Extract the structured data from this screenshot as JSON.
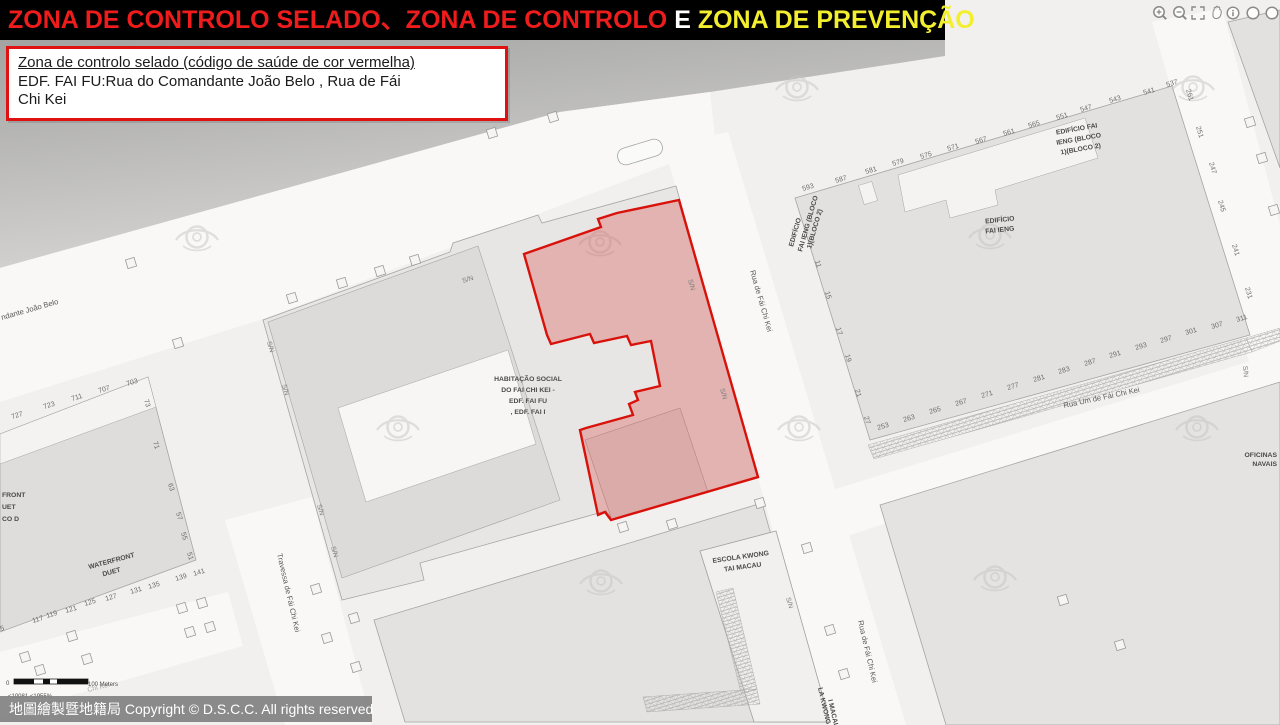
{
  "header": {
    "segments": {
      "red": "ZONA DE CONTROLO SELADO、ZONA DE CONTROLO ",
      "white": "E ",
      "yellow": "ZONA DE PREVENÇÃO"
    },
    "colors": {
      "red": "#ee1c1c",
      "white": "#ffffff",
      "yellow": "#f3ef2f",
      "bg": "#000000"
    }
  },
  "toolbar": {
    "icons": [
      "zoom-in",
      "zoom-out",
      "full-extent",
      "pan",
      "identify",
      "prev-extent",
      "next-extent"
    ]
  },
  "info_box": {
    "line1": "Zona de controlo selado (código de saúde de cor vermelha)",
    "line2": "EDF. FAI FU:Rua do Comandante João Belo , Rua de Fái",
    "line3": "Chi Kei",
    "border_color": "#e01111"
  },
  "zone": {
    "name": "Zona de controlo selado",
    "stroke": "#d8120b",
    "fill": "rgba(214,48,42,0.28)"
  },
  "scale_bar": {
    "zero": "0",
    "label": "100 Meters",
    "sub": "<10081  <1955%"
  },
  "copyright": {
    "text": "地圖繪製暨地籍局 Copyright © D.S.C.C. All rights reserved"
  },
  "map": {
    "labels": [
      {
        "t": "ndante João Belo",
        "x": 2,
        "y": 320,
        "r": -16,
        "c": "street"
      },
      {
        "t": "Rua de Fái Chi Kei",
        "x": 750,
        "y": 271,
        "r": 74,
        "c": "street"
      },
      {
        "t": "Rua Um de Fái Chi Kei",
        "x": 1064,
        "y": 408,
        "r": -12,
        "c": "street"
      },
      {
        "t": "Travessa de Fái Chi Kei",
        "x": 277,
        "y": 554,
        "r": 77,
        "c": "street"
      },
      {
        "t": "Rua de Fái Chi Kei",
        "x": 858,
        "y": 621,
        "r": 77,
        "c": "street"
      },
      {
        "t": "Chi Kei",
        "x": 88,
        "y": 692,
        "r": -14,
        "c": "faint"
      },
      {
        "t": "S/N",
        "x": 463,
        "y": 283,
        "r": -17,
        "c": "sn"
      },
      {
        "t": "S/N",
        "x": 688,
        "y": 280,
        "r": 74,
        "c": "sn"
      },
      {
        "t": "S/N",
        "x": 720,
        "y": 389,
        "r": 74,
        "c": "sn"
      },
      {
        "t": "S/N",
        "x": 267,
        "y": 342,
        "r": 74,
        "c": "sn"
      },
      {
        "t": "S/N",
        "x": 282,
        "y": 385,
        "r": 74,
        "c": "sn"
      },
      {
        "t": "S/N",
        "x": 317,
        "y": 505,
        "r": 74,
        "c": "sn"
      },
      {
        "t": "S/N",
        "x": 331,
        "y": 547,
        "r": 74,
        "c": "sn"
      },
      {
        "t": "S/N",
        "x": 786,
        "y": 598,
        "r": 74,
        "c": "sn"
      },
      {
        "t": "S/N",
        "x": 1243,
        "y": 366,
        "r": 85,
        "c": "sn"
      },
      {
        "t": "HABITAÇÃO SOCIAL",
        "x": 528,
        "y": 381,
        "c": "bldg",
        "a": "middle"
      },
      {
        "t": "DO FAI CHI KEI -",
        "x": 528,
        "y": 392,
        "c": "bldg",
        "a": "middle"
      },
      {
        "t": "EDF. FAI FU",
        "x": 528,
        "y": 403,
        "c": "bldg",
        "a": "middle"
      },
      {
        "t": ", EDF. FAI I",
        "x": 528,
        "y": 414,
        "c": "bldg",
        "a": "middle"
      },
      {
        "t": "EDIFÍCIO",
        "x": 1000,
        "y": 222,
        "r": -6,
        "c": "bldg",
        "a": "middle"
      },
      {
        "t": "FAI IENG",
        "x": 1000,
        "y": 232,
        "r": -6,
        "c": "bldg",
        "a": "middle"
      },
      {
        "t": "EDIFÍCIO FAI",
        "x": 1077,
        "y": 131,
        "r": -10,
        "c": "bldg",
        "a": "middle"
      },
      {
        "t": "IENG (BLOCO",
        "x": 1079,
        "y": 141,
        "r": -10,
        "c": "bldg",
        "a": "middle"
      },
      {
        "t": "1)(BLOCO 2)",
        "x": 1081,
        "y": 151,
        "r": -10,
        "c": "bldg",
        "a": "middle"
      },
      {
        "t": "EDIFÍCIO",
        "x": 793,
        "y": 247,
        "r": -74,
        "c": "bldg"
      },
      {
        "t": "FAI IENG (BLOCO",
        "x": 802,
        "y": 252,
        "r": -74,
        "c": "bldg"
      },
      {
        "t": "1)(BLOCO 2)",
        "x": 811,
        "y": 249,
        "r": -74,
        "c": "bldg"
      },
      {
        "t": "ESCOLA KWONG",
        "x": 741,
        "y": 559,
        "r": -8,
        "c": "bldg",
        "a": "middle"
      },
      {
        "t": "TAI MACAU",
        "x": 743,
        "y": 569,
        "r": -8,
        "c": "bldg",
        "a": "middle"
      },
      {
        "t": "WATERFRONT",
        "x": 112,
        "y": 563,
        "r": -15,
        "c": "bldg",
        "a": "middle"
      },
      {
        "t": "DUET",
        "x": 112,
        "y": 574,
        "r": -15,
        "c": "bldg",
        "a": "middle"
      },
      {
        "t": "OFICINAS",
        "x": 1277,
        "y": 457,
        "c": "bldg",
        "a": "end"
      },
      {
        "t": "NAVAIS",
        "x": 1277,
        "y": 466,
        "c": "bldg",
        "a": "end"
      },
      {
        "t": "FRONT",
        "x": 2,
        "y": 497,
        "c": "bldg"
      },
      {
        "t": "UET",
        "x": 2,
        "y": 509,
        "c": "bldg"
      },
      {
        "t": "CO D",
        "x": 2,
        "y": 521,
        "c": "bldg"
      },
      {
        "t": "LA KWONG",
        "x": 818,
        "y": 688,
        "r": 77,
        "c": "bldg"
      },
      {
        "t": "I MACAU",
        "x": 828,
        "y": 700,
        "r": 77,
        "c": "bldg"
      },
      {
        "t": "593",
        "x": 803,
        "y": 191,
        "r": -17
      },
      {
        "t": "587",
        "x": 836,
        "y": 183,
        "r": -17
      },
      {
        "t": "581",
        "x": 866,
        "y": 174,
        "r": -17
      },
      {
        "t": "579",
        "x": 893,
        "y": 166,
        "r": -17
      },
      {
        "t": "575",
        "x": 921,
        "y": 159,
        "r": -17
      },
      {
        "t": "571",
        "x": 948,
        "y": 151,
        "r": -17
      },
      {
        "t": "567",
        "x": 976,
        "y": 144,
        "r": -17
      },
      {
        "t": "561",
        "x": 1004,
        "y": 136,
        "r": -17
      },
      {
        "t": "565",
        "x": 1029,
        "y": 128,
        "r": -17
      },
      {
        "t": "551",
        "x": 1057,
        "y": 120,
        "r": -17
      },
      {
        "t": "547",
        "x": 1081,
        "y": 112,
        "r": -17
      },
      {
        "t": "543",
        "x": 1110,
        "y": 103,
        "r": -17
      },
      {
        "t": "541",
        "x": 1144,
        "y": 95,
        "r": -17
      },
      {
        "t": "537",
        "x": 1167,
        "y": 87,
        "r": -17
      },
      {
        "t": "261",
        "x": 1186,
        "y": 90,
        "r": 73
      },
      {
        "t": "251",
        "x": 1196,
        "y": 127,
        "r": 73
      },
      {
        "t": "247",
        "x": 1209,
        "y": 163,
        "r": 73
      },
      {
        "t": "245",
        "x": 1218,
        "y": 201,
        "r": 73
      },
      {
        "t": "241",
        "x": 1232,
        "y": 245,
        "r": 73
      },
      {
        "t": "231",
        "x": 1245,
        "y": 288,
        "r": 73
      },
      {
        "t": "11",
        "x": 815,
        "y": 261,
        "r": 73
      },
      {
        "t": "15",
        "x": 825,
        "y": 292,
        "r": 73
      },
      {
        "t": "17",
        "x": 836,
        "y": 328,
        "r": 73
      },
      {
        "t": "19",
        "x": 845,
        "y": 355,
        "r": 73
      },
      {
        "t": "21",
        "x": 855,
        "y": 390,
        "r": 73
      },
      {
        "t": "27",
        "x": 864,
        "y": 417,
        "r": 73
      },
      {
        "t": "253",
        "x": 878,
        "y": 430,
        "r": -17
      },
      {
        "t": "263",
        "x": 904,
        "y": 422,
        "r": -17
      },
      {
        "t": "265",
        "x": 930,
        "y": 414,
        "r": -17
      },
      {
        "t": "267",
        "x": 956,
        "y": 406,
        "r": -17
      },
      {
        "t": "271",
        "x": 982,
        "y": 398,
        "r": -17
      },
      {
        "t": "277",
        "x": 1008,
        "y": 390,
        "r": -17
      },
      {
        "t": "281",
        "x": 1034,
        "y": 382,
        "r": -17
      },
      {
        "t": "283",
        "x": 1059,
        "y": 374,
        "r": -17
      },
      {
        "t": "287",
        "x": 1085,
        "y": 366,
        "r": -17
      },
      {
        "t": "291",
        "x": 1110,
        "y": 358,
        "r": -17
      },
      {
        "t": "293",
        "x": 1136,
        "y": 350,
        "r": -17
      },
      {
        "t": "297",
        "x": 1161,
        "y": 343,
        "r": -17
      },
      {
        "t": "301",
        "x": 1186,
        "y": 335,
        "r": -17
      },
      {
        "t": "307",
        "x": 1212,
        "y": 329,
        "r": -17
      },
      {
        "t": "311",
        "x": 1237,
        "y": 322,
        "r": -17
      },
      {
        "t": "727",
        "x": 12,
        "y": 419,
        "r": -17
      },
      {
        "t": "723",
        "x": 44,
        "y": 409,
        "r": -17
      },
      {
        "t": "711",
        "x": 72,
        "y": 401,
        "r": -17
      },
      {
        "t": "707",
        "x": 99,
        "y": 393,
        "r": -17
      },
      {
        "t": "703",
        "x": 127,
        "y": 386,
        "r": -17
      },
      {
        "t": "73",
        "x": 144,
        "y": 400,
        "r": 73
      },
      {
        "t": "71",
        "x": 153,
        "y": 442,
        "r": 73
      },
      {
        "t": "63",
        "x": 168,
        "y": 484,
        "r": 73
      },
      {
        "t": "57",
        "x": 176,
        "y": 513,
        "r": 73
      },
      {
        "t": "55",
        "x": 181,
        "y": 533,
        "r": 73
      },
      {
        "t": "51",
        "x": 187,
        "y": 553,
        "r": 73
      },
      {
        "t": "5",
        "x": 1,
        "y": 631,
        "r": -17
      },
      {
        "t": "117",
        "x": 33,
        "y": 623,
        "r": -17
      },
      {
        "t": "119",
        "x": 47,
        "y": 618,
        "r": -17
      },
      {
        "t": "121",
        "x": 66,
        "y": 613,
        "r": -17
      },
      {
        "t": "125",
        "x": 85,
        "y": 606,
        "r": -17
      },
      {
        "t": "127",
        "x": 106,
        "y": 601,
        "r": -17
      },
      {
        "t": "131",
        "x": 131,
        "y": 594,
        "r": -17
      },
      {
        "t": "135",
        "x": 149,
        "y": 589,
        "r": -17
      },
      {
        "t": "139",
        "x": 176,
        "y": 581,
        "r": -17
      },
      {
        "t": "141",
        "x": 194,
        "y": 576,
        "r": -17
      },
      {
        "t": "0",
        "x": 6,
        "y": 685,
        "c": "scale"
      },
      {
        "t": "100 Meters",
        "x": 88,
        "y": 686,
        "c": "scale"
      },
      {
        "t": "<10081  <1955%",
        "x": 8,
        "y": 698,
        "c": "scale"
      }
    ]
  }
}
